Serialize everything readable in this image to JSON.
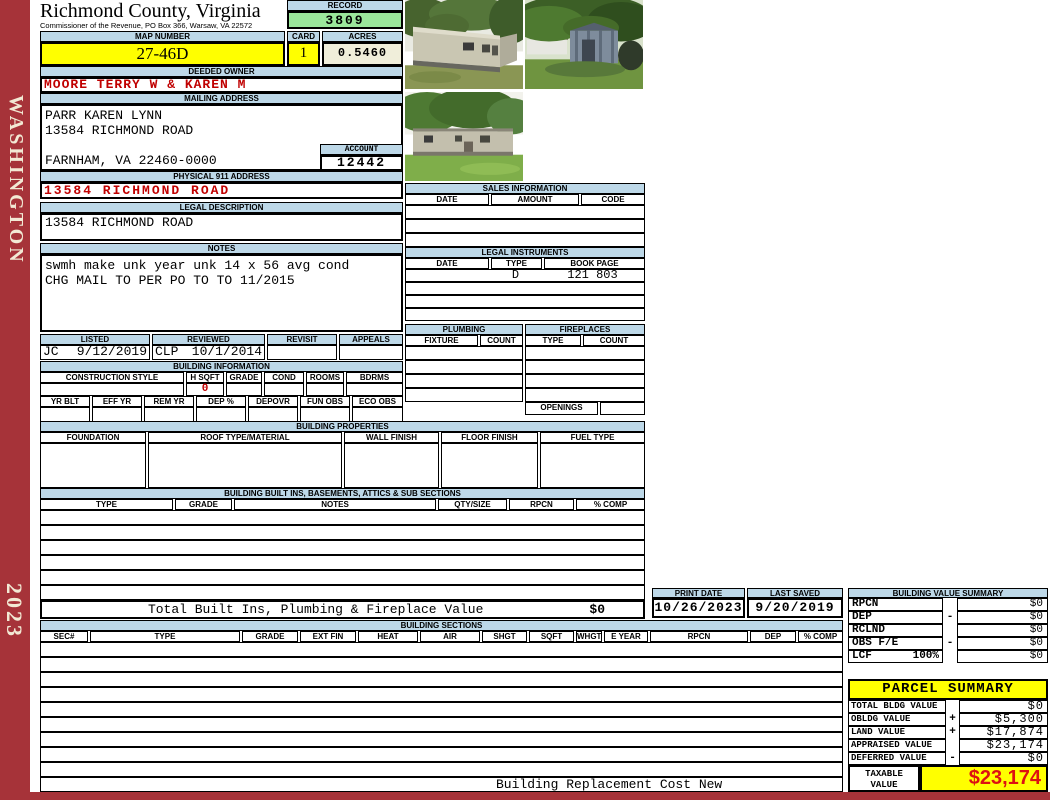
{
  "colors": {
    "header_blue": "#BDD8E8",
    "record_green": "#9BE79B",
    "highlight_yellow": "#FFFF00",
    "acres_cream": "#F0EEDA",
    "sidebar_red": "#A63339",
    "red_text": "#C00000",
    "taxable_red": "#DD1111"
  },
  "sidebar": {
    "state": "WASHINGTON",
    "year": "2023"
  },
  "header": {
    "title": "Richmond County, Virginia",
    "subtitle": "Commissioner of the Revenue, PO Box 366, Warsaw, VA 22572",
    "record_label": "RECORD",
    "record_value": "3809",
    "map_number_label": "MAP NUMBER",
    "map_number": "27-46D",
    "card_label": "CARD",
    "card": "1",
    "acres_label": "ACRES",
    "acres": "0.5460"
  },
  "owner": {
    "label": "DEEDED OWNER",
    "name": "MOORE TERRY W & KAREN M"
  },
  "mailing": {
    "label": "MAILING ADDRESS",
    "line1": "PARR KAREN LYNN",
    "line2": "13584 RICHMOND ROAD",
    "line3": "FARNHAM, VA 22460-0000",
    "account_label": "ACCOUNT",
    "account": "12442"
  },
  "physical_address": {
    "label": "PHYSICAL 911 ADDRESS",
    "value": "13584 RICHMOND ROAD"
  },
  "legal_description": {
    "label": "LEGAL DESCRIPTION",
    "value": "13584 RICHMOND ROAD"
  },
  "notes": {
    "label": "NOTES",
    "line1": "swmh make unk year unk 14 x 56 avg cond",
    "line2": "CHG MAIL TO PER PO TO TO 11/2015"
  },
  "review": {
    "listed_label": "LISTED",
    "reviewed_label": "REVIEWED",
    "revisit_label": "REVISIT",
    "appeals_label": "APPEALS",
    "listed_by": "JC",
    "listed_date": "9/12/2019",
    "reviewed_by": "CLP",
    "reviewed_date": "10/1/2014"
  },
  "building_information": {
    "label": "BUILDING INFORMATION",
    "columns_row1": [
      "CONSTRUCTION STYLE",
      "H SQFT",
      "GRADE",
      "COND",
      "ROOMS",
      "BDRMS"
    ],
    "h_sqft_value": "0",
    "columns_row2": [
      "YR BLT",
      "EFF YR",
      "REM YR",
      "DEP %",
      "DEPOVR",
      "FUN OBS",
      "ECO OBS"
    ]
  },
  "building_properties": {
    "label": "BUILDING PROPERTIES",
    "columns": [
      "FOUNDATION",
      "ROOF TYPE/MATERIAL",
      "WALL FINISH",
      "FLOOR FINISH",
      "FUEL TYPE"
    ]
  },
  "built_ins": {
    "label": "BUILDING BUILT INS, BASEMENTS, ATTICS & SUB SECTIONS",
    "columns": [
      "TYPE",
      "GRADE",
      "NOTES",
      "QTY/SIZE",
      "RPCN",
      "% COMP"
    ],
    "total_label": "Total Built Ins, Plumbing & Fireplace Value",
    "total_value": "$0"
  },
  "sales": {
    "label": "SALES INFORMATION",
    "columns": [
      "DATE",
      "AMOUNT",
      "CODE"
    ]
  },
  "legal_instruments": {
    "label": "LEGAL INSTRUMENTS",
    "columns": [
      "DATE",
      "TYPE",
      "BOOK PAGE"
    ],
    "row1": {
      "date": "",
      "type": "D",
      "book_page": "121 803"
    }
  },
  "plumbing": {
    "label": "PLUMBING",
    "columns": [
      "FIXTURE",
      "COUNT"
    ]
  },
  "fireplaces": {
    "label": "FIREPLACES",
    "columns": [
      "TYPE",
      "COUNT"
    ],
    "openings_label": "OPENINGS"
  },
  "print_info": {
    "print_date_label": "PRINT DATE",
    "print_date": "10/26/2023",
    "last_saved_label": "LAST SAVED",
    "last_saved": "9/20/2019"
  },
  "building_value_summary": {
    "label": "BUILDING VALUE SUMMARY",
    "rows": [
      {
        "label": "RPCN",
        "pct": "",
        "sign": "",
        "value": "$0"
      },
      {
        "label": "DEP",
        "pct": "",
        "sign": "-",
        "value": "$0"
      },
      {
        "label": "RCLND",
        "pct": "",
        "sign": "",
        "value": "$0"
      },
      {
        "label": "OBS F/E",
        "pct": "",
        "sign": "-",
        "value": "$0"
      },
      {
        "label": "LCF",
        "pct": "100%",
        "sign": "",
        "value": "$0"
      }
    ]
  },
  "building_sections": {
    "label": "BUILDING SECTIONS",
    "columns": [
      "SEC#",
      "TYPE",
      "GRADE",
      "EXT FIN",
      "HEAT",
      "AIR",
      "SHGT",
      "SQFT",
      "WHGT",
      "E YEAR",
      "RPCN",
      "DEP",
      "% COMP"
    ],
    "footer_note": "Building Replacement Cost New"
  },
  "parcel_summary": {
    "label": "PARCEL SUMMARY",
    "rows": [
      {
        "label": "TOTAL BLDG VALUE",
        "sign": "",
        "value": "$0"
      },
      {
        "label": "OBLDG VALUE",
        "sign": "+",
        "value": "$5,300"
      },
      {
        "label": "LAND VALUE",
        "sign": "+",
        "value": "$17,874"
      },
      {
        "label": "APPRAISED VALUE",
        "sign": "",
        "value": "$23,174"
      },
      {
        "label": "DEFERRED VALUE",
        "sign": "-",
        "value": "$0"
      }
    ],
    "taxable_label": "TAXABLE VALUE",
    "taxable_value": "$23,174"
  }
}
